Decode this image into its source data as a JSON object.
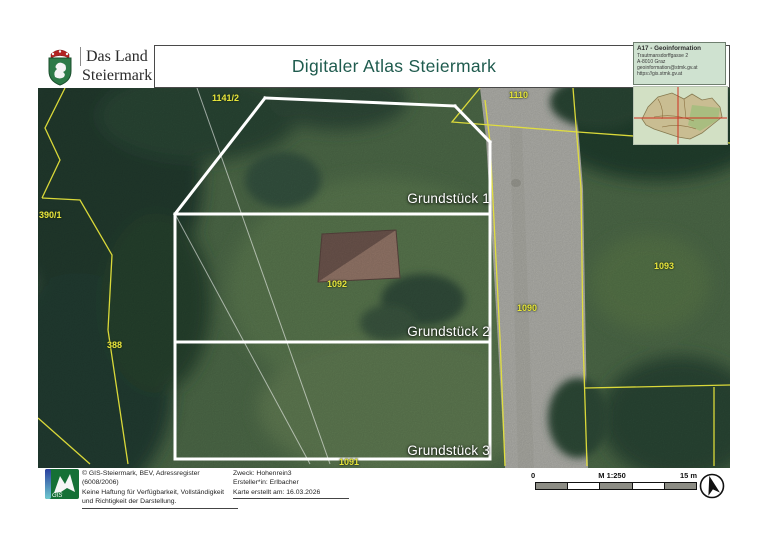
{
  "header": {
    "brand_line1": "Das Land",
    "brand_line2": "Steiermark",
    "title": "Digitaler Atlas Steiermark"
  },
  "info_box": {
    "department": "A17 - Geoinformation",
    "address_line1": "Trautmansdorffgasse 2",
    "address_line2": "A-8010 Graz",
    "email": "geoinformation@stmk.gv.at",
    "website": "https://gis.stmk.gv.at"
  },
  "map": {
    "parcel_labels": [
      {
        "text": "1141/2"
      },
      {
        "text": "1110"
      },
      {
        "text": "390/1"
      },
      {
        "text": "388"
      },
      {
        "text": "1092"
      },
      {
        "text": "1090"
      },
      {
        "text": "1093"
      },
      {
        "text": "1091"
      }
    ],
    "plot_labels": [
      {
        "text": "Grundstück 1"
      },
      {
        "text": "Grundstück 2"
      },
      {
        "text": "Grundstück 3"
      }
    ]
  },
  "footer": {
    "logo_text": "GIS",
    "copyright_line1": "© GIS-Steiermark, BEV, Adressregister (6008/2006)",
    "copyright_line2": "Keine Haftung für Verfügbarkeit, Vollständigkeit",
    "copyright_line3": "und Richtigkeit der Darstellung.",
    "purpose": "Zweck: Hohenrein3",
    "creator": "Ersteller*in: Erlbacher",
    "created": "Karte erstellt am: 16.03.2026",
    "scale_zero": "0",
    "scale_label": "M 1:250",
    "scale_max": "15 m"
  },
  "colors": {
    "title_green": "#1f5b4e",
    "cadastre_yellow": "#e8e53c",
    "parcel_line_white": "#ffffff",
    "info_box_bg": "#cfe2d0"
  }
}
